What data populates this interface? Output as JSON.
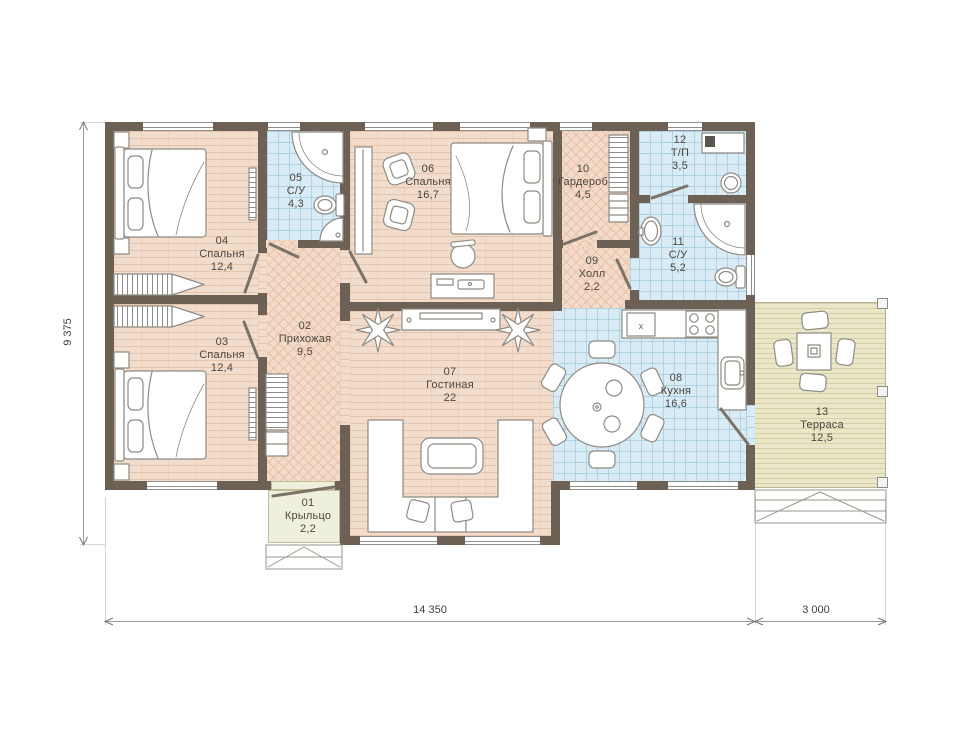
{
  "plan": {
    "rooms": [
      {
        "num": "01",
        "name": "Крыльцо",
        "area": "2,2"
      },
      {
        "num": "02",
        "name": "Прихожая",
        "area": "9,5"
      },
      {
        "num": "03",
        "name": "Спальня",
        "area": "12,4"
      },
      {
        "num": "04",
        "name": "Спальня",
        "area": "12,4"
      },
      {
        "num": "05",
        "name": "С/У",
        "area": "4,3"
      },
      {
        "num": "06",
        "name": "Спальня",
        "area": "16,7"
      },
      {
        "num": "07",
        "name": "Гостиная",
        "area": "22"
      },
      {
        "num": "08",
        "name": "Кухня",
        "area": "16,6"
      },
      {
        "num": "09",
        "name": "Холл",
        "area": "2,2"
      },
      {
        "num": "10",
        "name": "Гардероб",
        "area": "4,5"
      },
      {
        "num": "11",
        "name": "С/У",
        "area": "5,2"
      },
      {
        "num": "12",
        "name": "Т/П",
        "area": "3,5"
      },
      {
        "num": "13",
        "name": "Терраса",
        "area": "12,5"
      }
    ],
    "dimensions": {
      "bottom_main": "14 350",
      "bottom_right": "3 000",
      "left": "9 375"
    },
    "fixtures": {
      "kitchen_sink_mark": "x"
    },
    "palette": {
      "wall": "#6d6156",
      "wood_floor": "#f2dccb",
      "hatch_floor": "#f3dbca",
      "tile_floor": "#d9ecf6",
      "terrace_floor": "#eae7c8",
      "porch_floor": "#eef0dc",
      "furniture_line": "#8f8b84",
      "text": "#4c463e"
    }
  }
}
